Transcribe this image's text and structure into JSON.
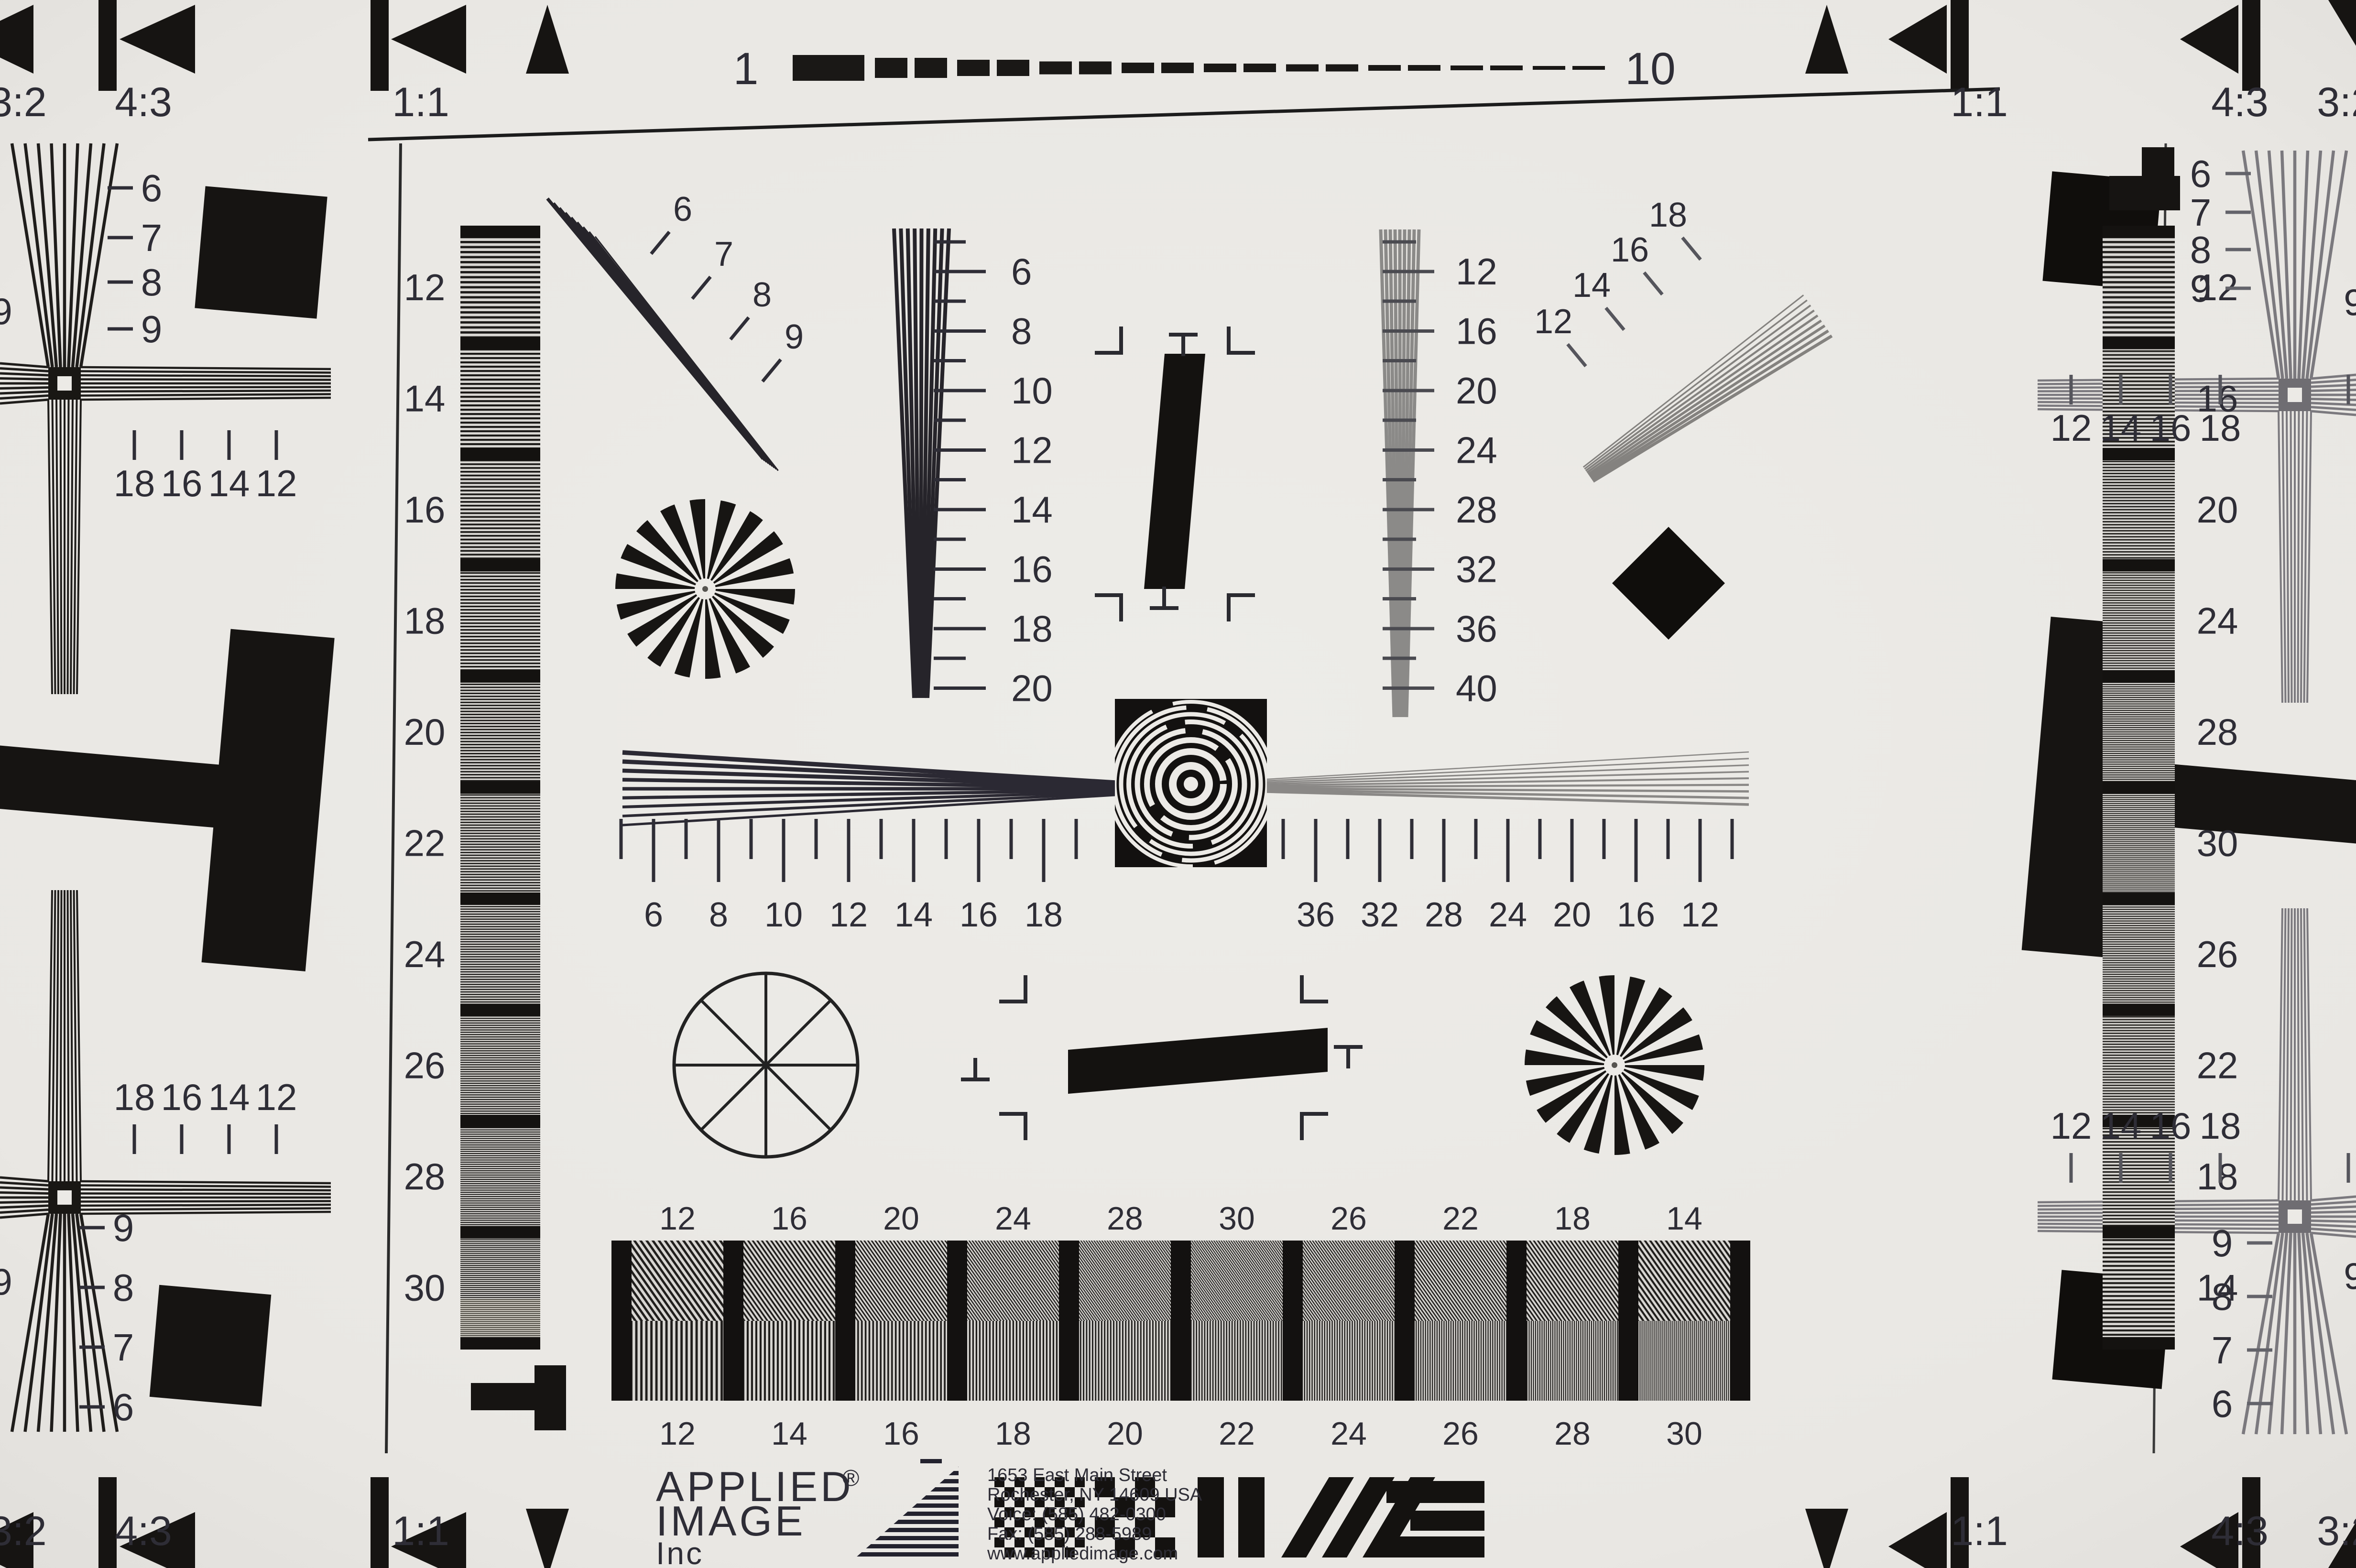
{
  "brand": {
    "name_line1": "APPLIED",
    "registered": "®",
    "name_line2": "IMAGE",
    "name_line3": "Inc",
    "address": [
      "1653 East Main Street",
      "Rochester, NY  14609  USA",
      "Voice:   (585) 482-0300",
      "Fax:      (585) 288-5989",
      "www.appliedimage.com"
    ]
  },
  "ruler": {
    "start": "1",
    "end": "10"
  },
  "aspect": {
    "a32": "3:2",
    "a43": "4:3",
    "a11": "1:1"
  },
  "scales": {
    "left_bar": [
      "12",
      "14",
      "16",
      "18",
      "20",
      "22",
      "24",
      "26",
      "28",
      "30"
    ],
    "right_bar": [
      "12",
      "16",
      "20",
      "24",
      "28",
      "30",
      "26",
      "22",
      "18",
      "14"
    ],
    "left_wedge": [
      "6",
      "8",
      "10",
      "12",
      "14",
      "16",
      "18",
      "20"
    ],
    "right_wedge": [
      "12",
      "16",
      "20",
      "24",
      "28",
      "32",
      "36",
      "40"
    ],
    "center_left": [
      "6",
      "8",
      "10",
      "12",
      "14",
      "16",
      "18"
    ],
    "center_right": [
      "36",
      "32",
      "28",
      "24",
      "20",
      "16",
      "12"
    ],
    "diag_top_left": [
      "6",
      "7",
      "8",
      "9"
    ],
    "diag_top_right": [
      "12",
      "14",
      "16",
      "18"
    ],
    "stack_top_left": [
      "6",
      "7",
      "8",
      "9"
    ],
    "stack_bottom_left": [
      "9",
      "8",
      "7",
      "6"
    ],
    "stack_top_right": [
      "6",
      "7",
      "8",
      "9"
    ],
    "stack_bottom_right": [
      "9",
      "8",
      "7",
      "6"
    ],
    "ticks_top_left": [
      "18",
      "16",
      "14",
      "12"
    ],
    "ticks_bottom_left": [
      "18",
      "16",
      "14",
      "12"
    ],
    "ticks_top_right": [
      "12",
      "14",
      "16",
      "18"
    ],
    "ticks_bottom_right": [
      "12",
      "14",
      "16",
      "18"
    ],
    "edge_cut_digit": "9",
    "block_top": [
      "12",
      "16",
      "20",
      "24",
      "28",
      "30",
      "26",
      "22",
      "18",
      "14"
    ],
    "block_bottom": [
      "12",
      "14",
      "16",
      "18",
      "20",
      "22",
      "24",
      "26",
      "28",
      "30"
    ]
  },
  "colors": {
    "paper": "#eae8e4",
    "ink": "#161412",
    "gray_ink": "#7b797e",
    "label": "#2e2d36",
    "label_gray": "#63636a",
    "logo": "#23222c",
    "address": "#4a4952"
  }
}
